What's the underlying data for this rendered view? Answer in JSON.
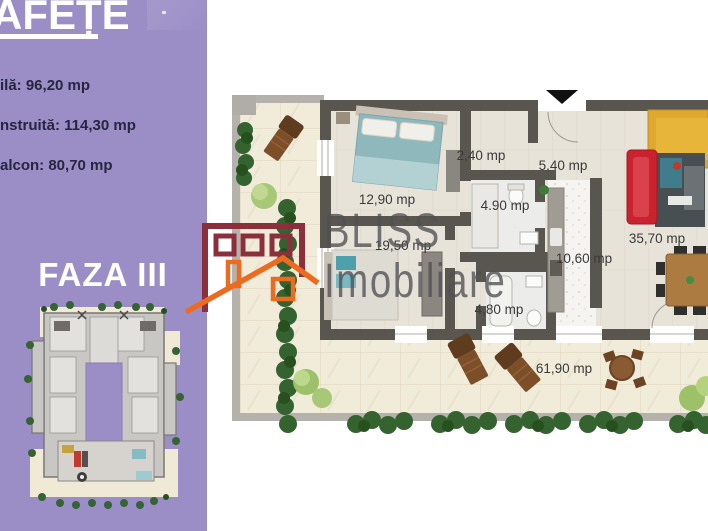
{
  "sidebar": {
    "title_fragment": "AFEȚE",
    "area_lines": [
      "ilă: 96,20 mp",
      "nstruită:  114,30 mp",
      "alcon: 80,70 mp"
    ],
    "phase_label": "FAZA III",
    "bg_color": "#9b8ec6",
    "text_color": "#26263f"
  },
  "logo": {
    "brand_line1": "BLISS",
    "brand_line2": "Imobiliare",
    "building_outline_color": "#8c2f3d",
    "roof_outline_color": "#ed6b21"
  },
  "floor_plan": {
    "unit_label": "apartment-plan",
    "rooms": [
      {
        "name": "bedroom-1",
        "area_label": "12,90 mp"
      },
      {
        "name": "hallway",
        "area_label": "2,40 mp"
      },
      {
        "name": "entry",
        "area_label": "5,40 mp"
      },
      {
        "name": "bathroom-1",
        "area_label": "4.90 mp"
      },
      {
        "name": "bedroom-2",
        "area_label": "19,50 mp"
      },
      {
        "name": "kitchen",
        "area_label": "10,60 mp"
      },
      {
        "name": "living-room",
        "area_label": "35,70 mp"
      },
      {
        "name": "bathroom-2",
        "area_label": "4,80 mp"
      },
      {
        "name": "terrace",
        "area_label": "61,90 mp"
      }
    ],
    "icons": {
      "entry_arrow": "down-triangle"
    },
    "colors": {
      "wall": "#59564f",
      "floor": "#e8e3d9",
      "terrace": "#f1ebda",
      "curb": "#b5b2ad",
      "bed_teal": "#8fb8bd",
      "sofa_red": "#c8232e",
      "sofa_yellow": "#dea92e",
      "wood_brown": "#7c4f28",
      "hedge_green": "#35632f"
    }
  }
}
